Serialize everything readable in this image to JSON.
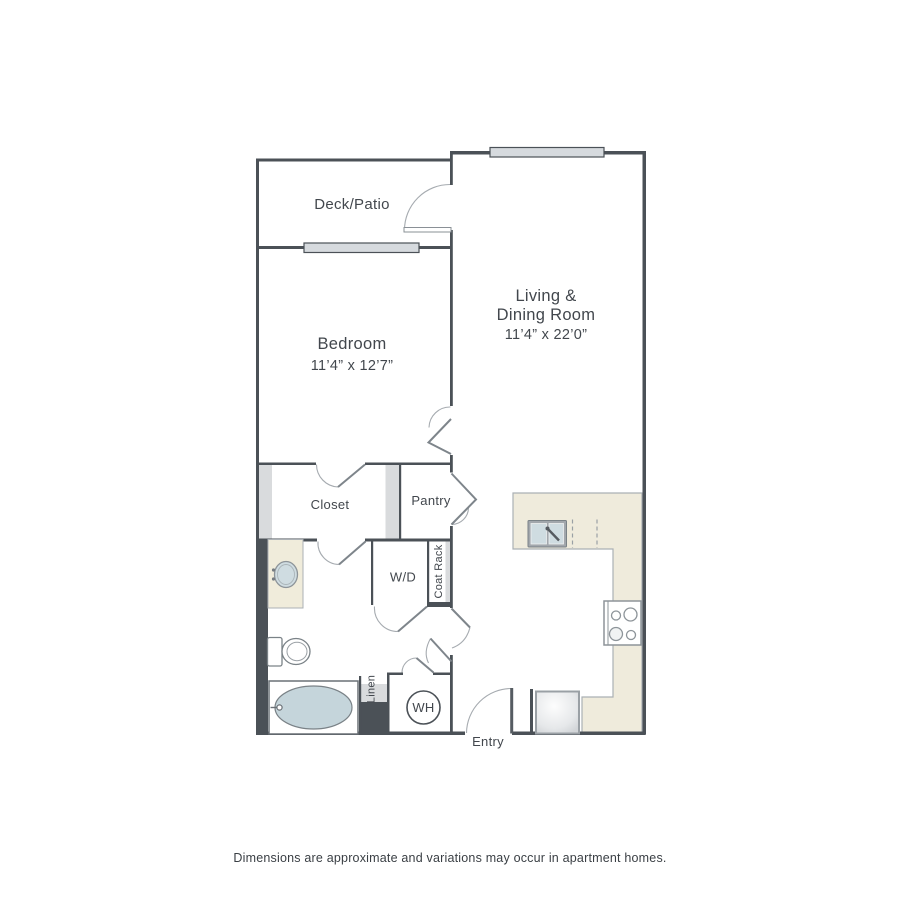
{
  "plan": {
    "rooms": {
      "deck_patio": {
        "label": "Deck/Patio"
      },
      "living_dining": {
        "label_line1": "Living &",
        "label_line2": "Dining Room",
        "dimensions": "11’4” x 22’0”"
      },
      "bedroom": {
        "label": "Bedroom",
        "dimensions": "11’4” x 12’7”"
      },
      "closet": {
        "label": "Closet"
      },
      "pantry": {
        "label": "Pantry"
      },
      "laundry": {
        "label": "W/D"
      },
      "coat_rack": {
        "label": "Coat Rack"
      },
      "linen": {
        "label": "Linen"
      },
      "water_heater": {
        "label": "WH"
      },
      "entry": {
        "label": "Entry"
      }
    },
    "fixtures": {
      "kitchen_sink": "double-basin sink",
      "dishwasher": "dashed appliance space",
      "stove": "4-burner cooktop",
      "refrigerator": "refrigerator",
      "vanity_sink": "oval vanity sink",
      "toilet": "toilet",
      "bathtub": "oval bathtub",
      "water_heater": "water heater"
    },
    "colors": {
      "wall": "#4b5157",
      "counter": "#efebdc",
      "water_fill": "#cfdce1",
      "shelf": "#d9dbdd",
      "text": "#42474d"
    },
    "footer": {
      "disclaimer": "Dimensions are approximate and variations may occur in apartment homes."
    }
  }
}
